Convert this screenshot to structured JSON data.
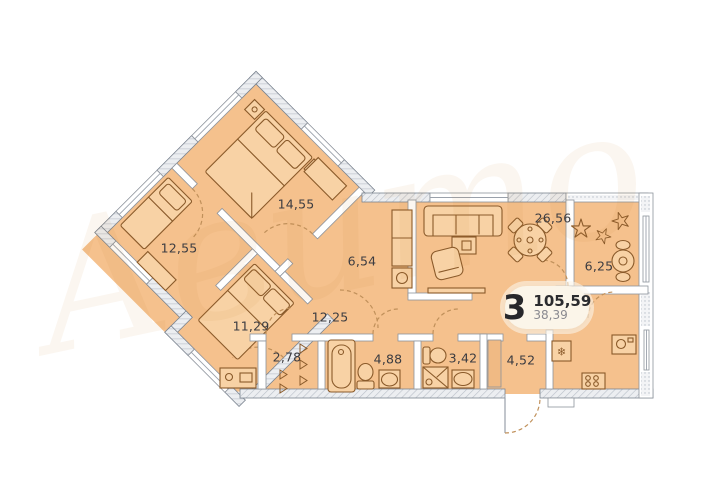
{
  "plan": {
    "summary": {
      "rooms_count": "3",
      "total_area": "105,59",
      "living_area": "38,39"
    },
    "rooms": [
      {
        "name": "bedroom-main",
        "area": "14,55"
      },
      {
        "name": "bedroom-left",
        "area": "12,55"
      },
      {
        "name": "bedroom-lower",
        "area": "11,29"
      },
      {
        "name": "inner-hall",
        "area": "6,54"
      },
      {
        "name": "corridor",
        "area": "12,25"
      },
      {
        "name": "wardrobe",
        "area": "2,78"
      },
      {
        "name": "bathroom",
        "area": "4,88"
      },
      {
        "name": "shower-wc",
        "area": "3,42"
      },
      {
        "name": "entry-hall",
        "area": "4,52"
      },
      {
        "name": "living-kitchen",
        "area": "26,56"
      },
      {
        "name": "balcony",
        "area": "6,25"
      }
    ],
    "icons": {
      "fridge": "❄"
    },
    "watermark": "Авито",
    "colors": {
      "floor": "#f5c18d",
      "wall": "#eceef1",
      "furniture_line": "#8a5a2a",
      "badge_bg": "#fbf5e9"
    }
  }
}
